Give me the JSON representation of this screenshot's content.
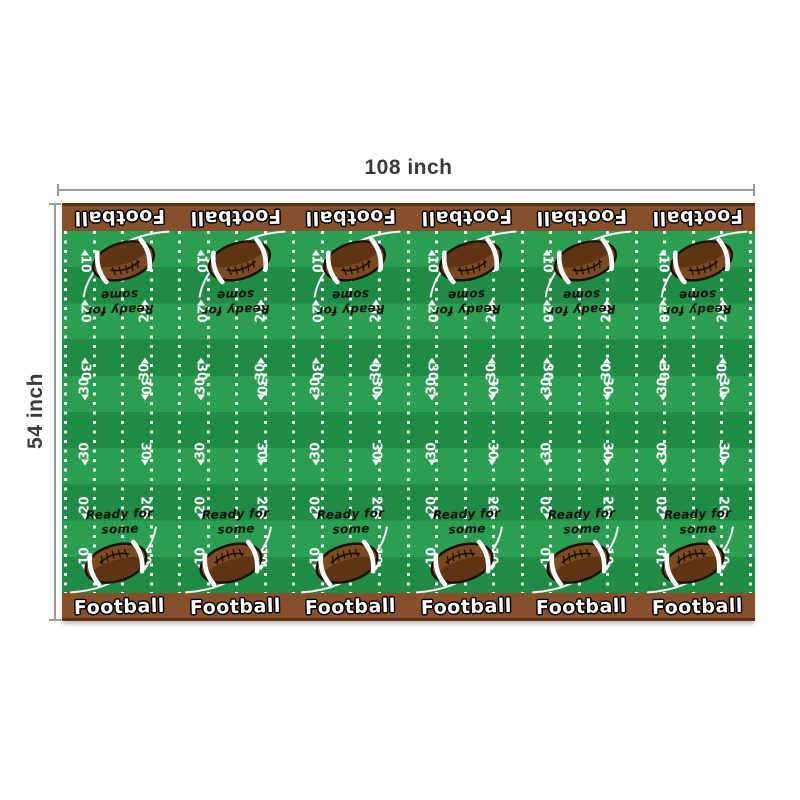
{
  "annotations": {
    "width_label": "108 inch",
    "height_label": "54 inch",
    "line_color": "#9a9a9a",
    "text_color": "#3a3a3a"
  },
  "tablecloth": {
    "panel_count": 6,
    "border_word": "Football",
    "ready_text": {
      "line1": "Ready for",
      "line2": "some"
    },
    "yard_rows": [
      {
        "label": "10",
        "y": "8%",
        "arrow": "up",
        "half": "top"
      },
      {
        "label": "20",
        "y": "21.8%",
        "arrow": "up",
        "half": "top"
      },
      {
        "label": "30",
        "y": "37.8%",
        "arrow": "up",
        "half": "top"
      },
      {
        "label": "30",
        "y": "43.9%",
        "arrow": "down",
        "half": "bottom"
      },
      {
        "label": "30",
        "y": "61.9%",
        "arrow": "down",
        "half": "bottom"
      },
      {
        "label": "20",
        "y": "76.8%",
        "arrow": "down",
        "half": "bottom"
      },
      {
        "label": "10",
        "y": "91%",
        "arrow": "down",
        "half": "bottom"
      }
    ],
    "colors": {
      "stripe_light": "#2b9e51",
      "stripe_dark": "#1f8b45",
      "border_brown": "#85502b",
      "border_brown_dark": "#5c3317",
      "ball_brown": "#7b4a22",
      "ball_shadow": "#5e3414",
      "ball_outline": "#1c1006"
    }
  }
}
